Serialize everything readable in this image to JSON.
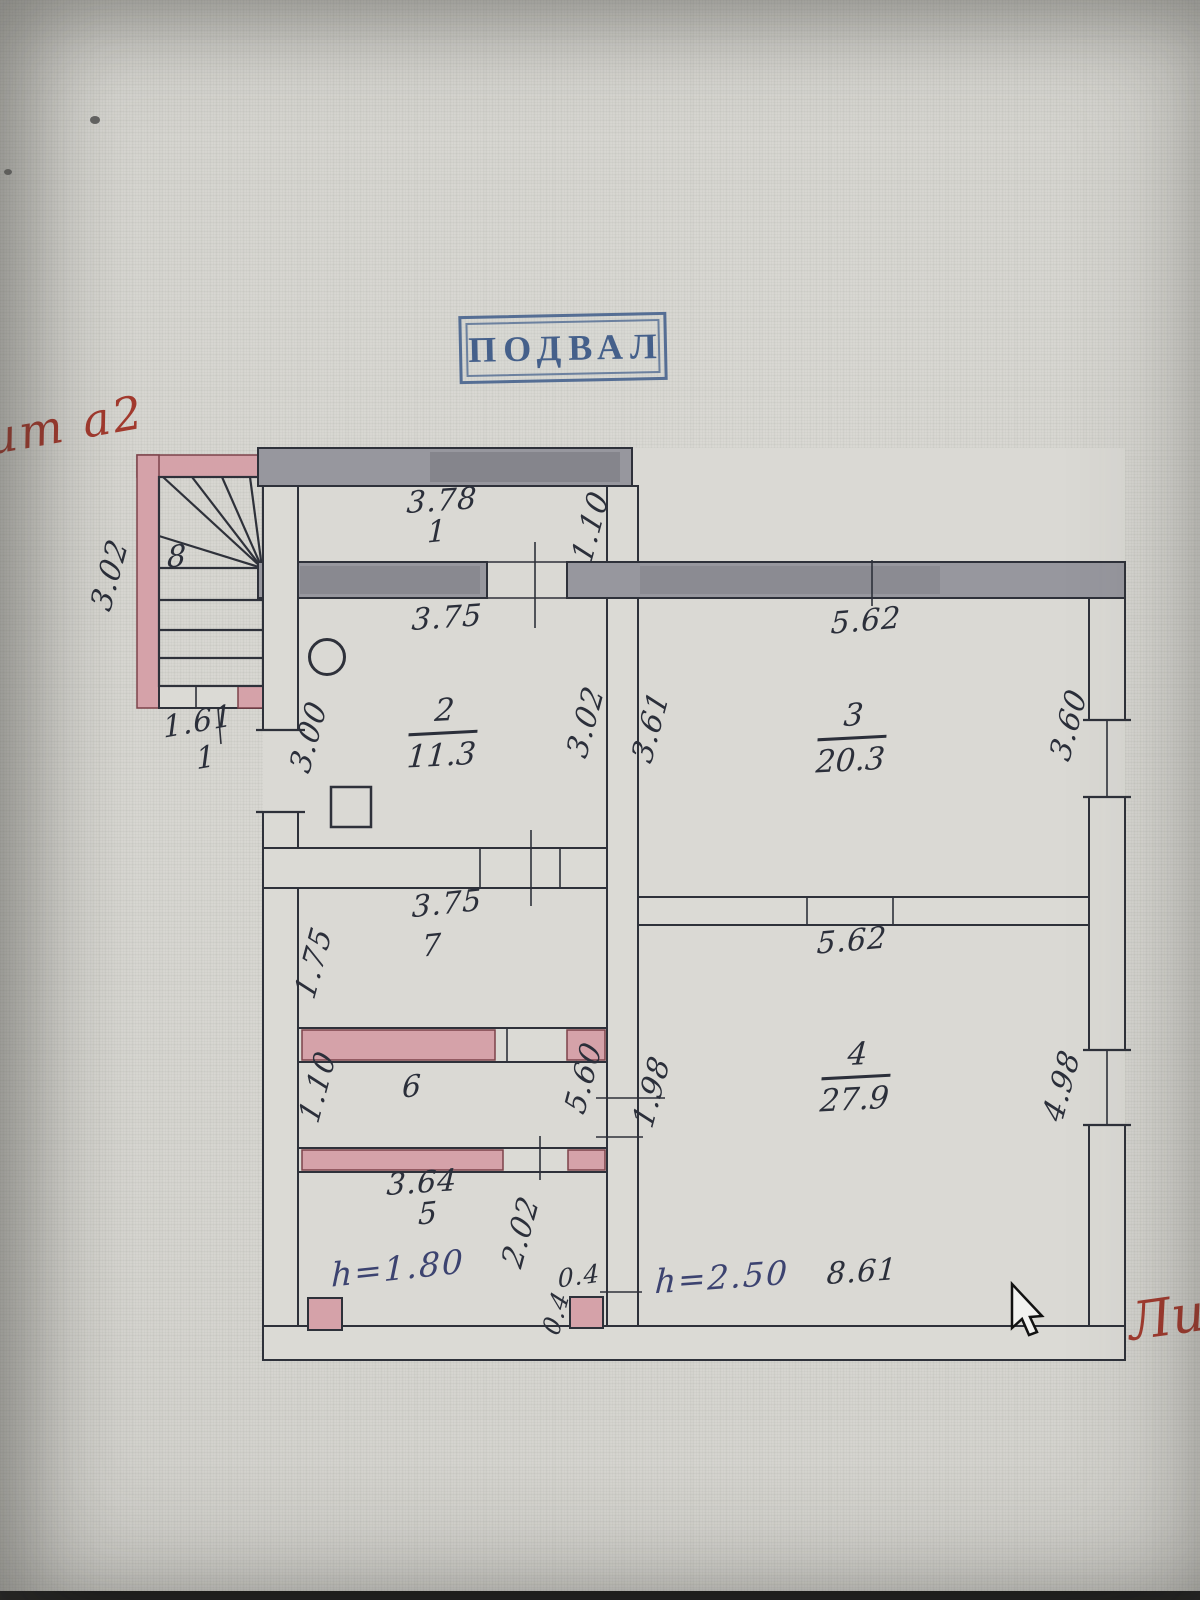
{
  "stamp": {
    "text": "ПОДВАЛ",
    "color": "#3e5c8a"
  },
  "red_notes": {
    "top_left": "ит а2",
    "bottom_right": "Ли",
    "ink_color": "#a23a2e"
  },
  "colors": {
    "drawing_ink": "#2e313a",
    "pencil_wall": "#97979e",
    "pink_wall": "#d5a2a9",
    "paper": "#d6d5d0"
  },
  "rooms": {
    "r1": {
      "number": "1",
      "top": "3.78",
      "right": "1.10"
    },
    "r2": {
      "number": "2",
      "area": "11.3",
      "top": "3.75",
      "left": "3.00",
      "right": "3.02"
    },
    "r3": {
      "number": "3",
      "area": "20.3",
      "top": "5.62",
      "left": "3.61",
      "right": "3.60"
    },
    "r4": {
      "number": "4",
      "area": "27.9",
      "top": "5.62",
      "left": "1.98",
      "right": "4.98",
      "height": "h=2.50",
      "bottom": "8.61"
    },
    "r5": {
      "number": "5",
      "top": "3.64",
      "right": "2.02",
      "height": "h=1.80",
      "pier_width": "0.4",
      "pier_height": "0.4"
    },
    "r6": {
      "number": "6",
      "left": "1.10",
      "right": "5.60"
    },
    "r7": {
      "number": "7",
      "top": "3.75",
      "left": "1.75"
    },
    "r8": {
      "number": "8",
      "left": "3.02",
      "bottom": "1.61",
      "bottom_sub": "1"
    }
  }
}
